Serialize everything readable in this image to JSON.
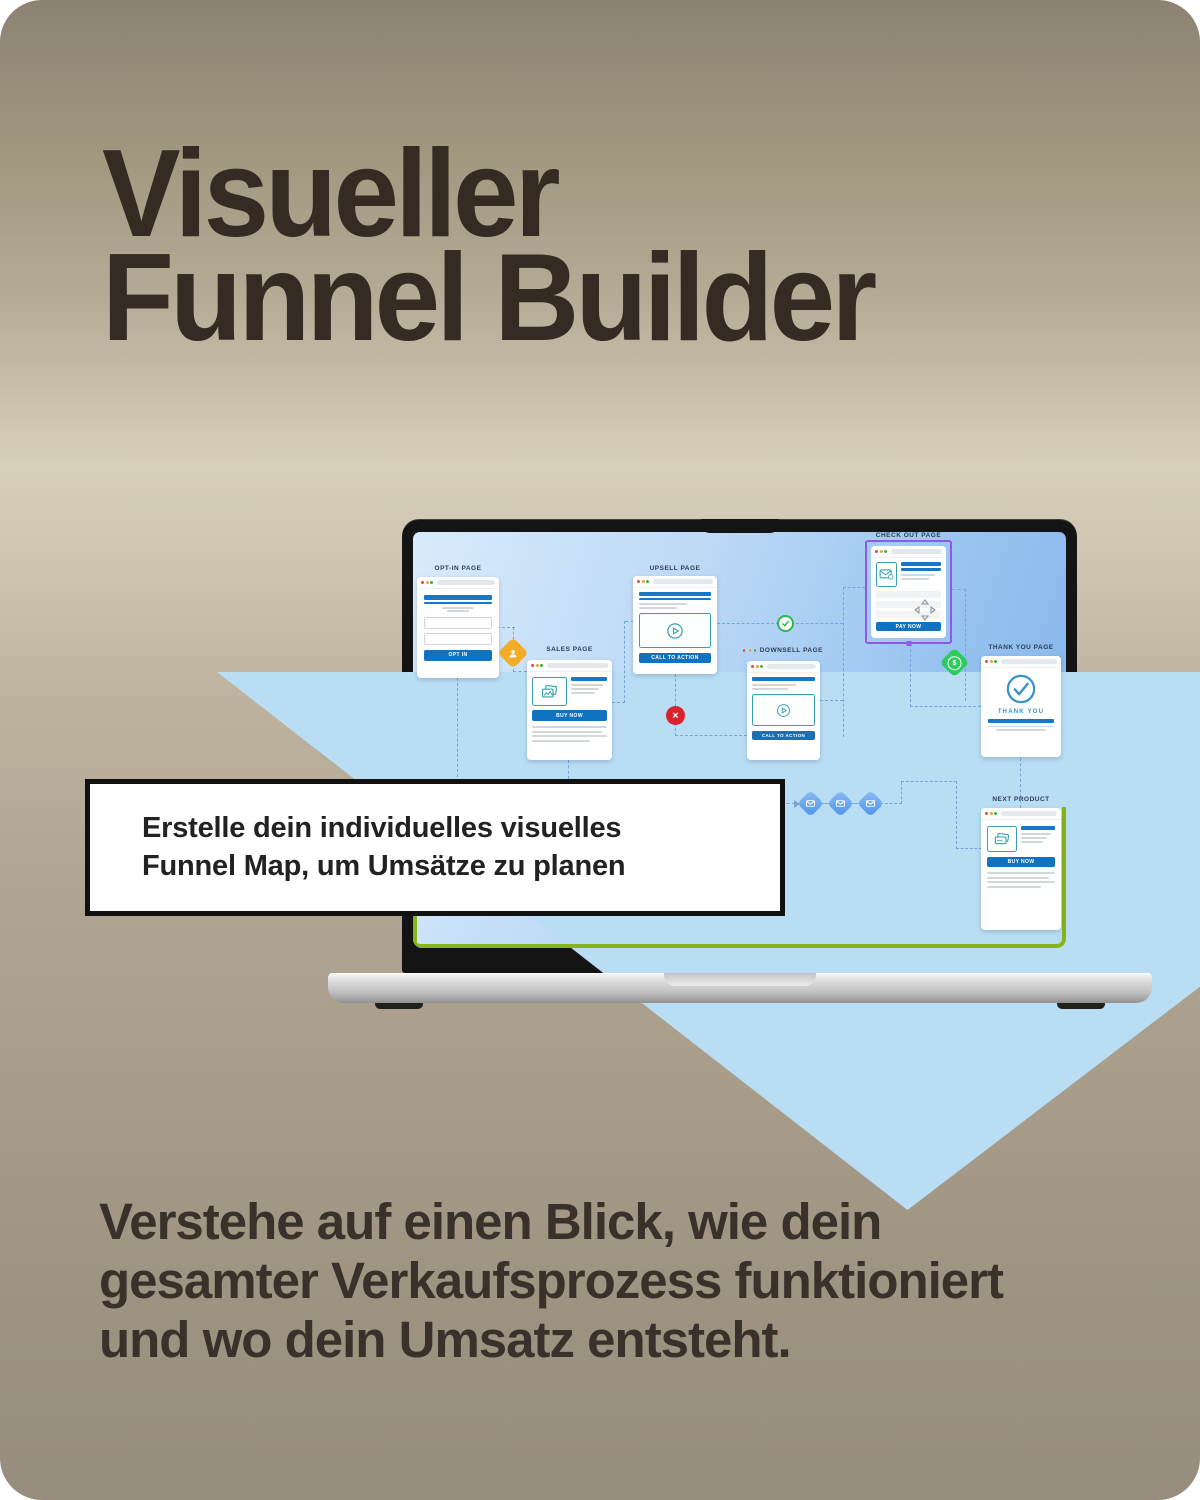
{
  "poster": {
    "title": {
      "line1": "Visueller",
      "line2": "Funnel Builder"
    },
    "callout": {
      "line1": "Erstelle dein individuelles visuelles",
      "line2": "Funnel Map, um Umsätze zu planen"
    },
    "footer": {
      "line1": "Verstehe auf einen Blick, wie dein",
      "line2": "gesamter Verkaufsprozess funktioniert",
      "line3": "und wo dein Umsatz entsteht."
    }
  },
  "funnel_map": {
    "cards": {
      "opt_in": {
        "label": "OPT-IN PAGE",
        "button": "OPT IN"
      },
      "sales": {
        "label": "SALES PAGE",
        "button": "BUY NOW"
      },
      "upsell": {
        "label": "UPSELL PAGE",
        "button": "CALL TO ACTION"
      },
      "downsell": {
        "label": "DOWNSELL PAGE",
        "button": "CALL TO ACTION"
      },
      "checkout": {
        "label": "CHECK OUT PAGE",
        "button": "PAY NOW"
      },
      "thank_you": {
        "label": "THANK YOU PAGE",
        "message": "THANK YOU"
      },
      "next_product": {
        "label": "NEXT PRODUCT",
        "button": "BUY NOW"
      }
    },
    "icons": {
      "lead": "person-diamond",
      "success": "check-circle",
      "failure": "x-circle",
      "revenue": "dollar-diamond",
      "emails": [
        "email-diamond",
        "email-diamond",
        "email-diamond"
      ],
      "drag": "move-handle",
      "dollar_sign": "$"
    },
    "colors": {
      "accent_blue": "#1778c5",
      "selection_purple": "#9257e3",
      "success_green": "#2db84f",
      "error_red": "#d8232e",
      "lead_orange": "#f3ac28",
      "money_green": "#2ecc5e",
      "email_blue": "#69a6ee",
      "canvas_border": "#87b418",
      "arrow_blue": "#b9ddf3",
      "teal_outline": "#359fae"
    }
  }
}
